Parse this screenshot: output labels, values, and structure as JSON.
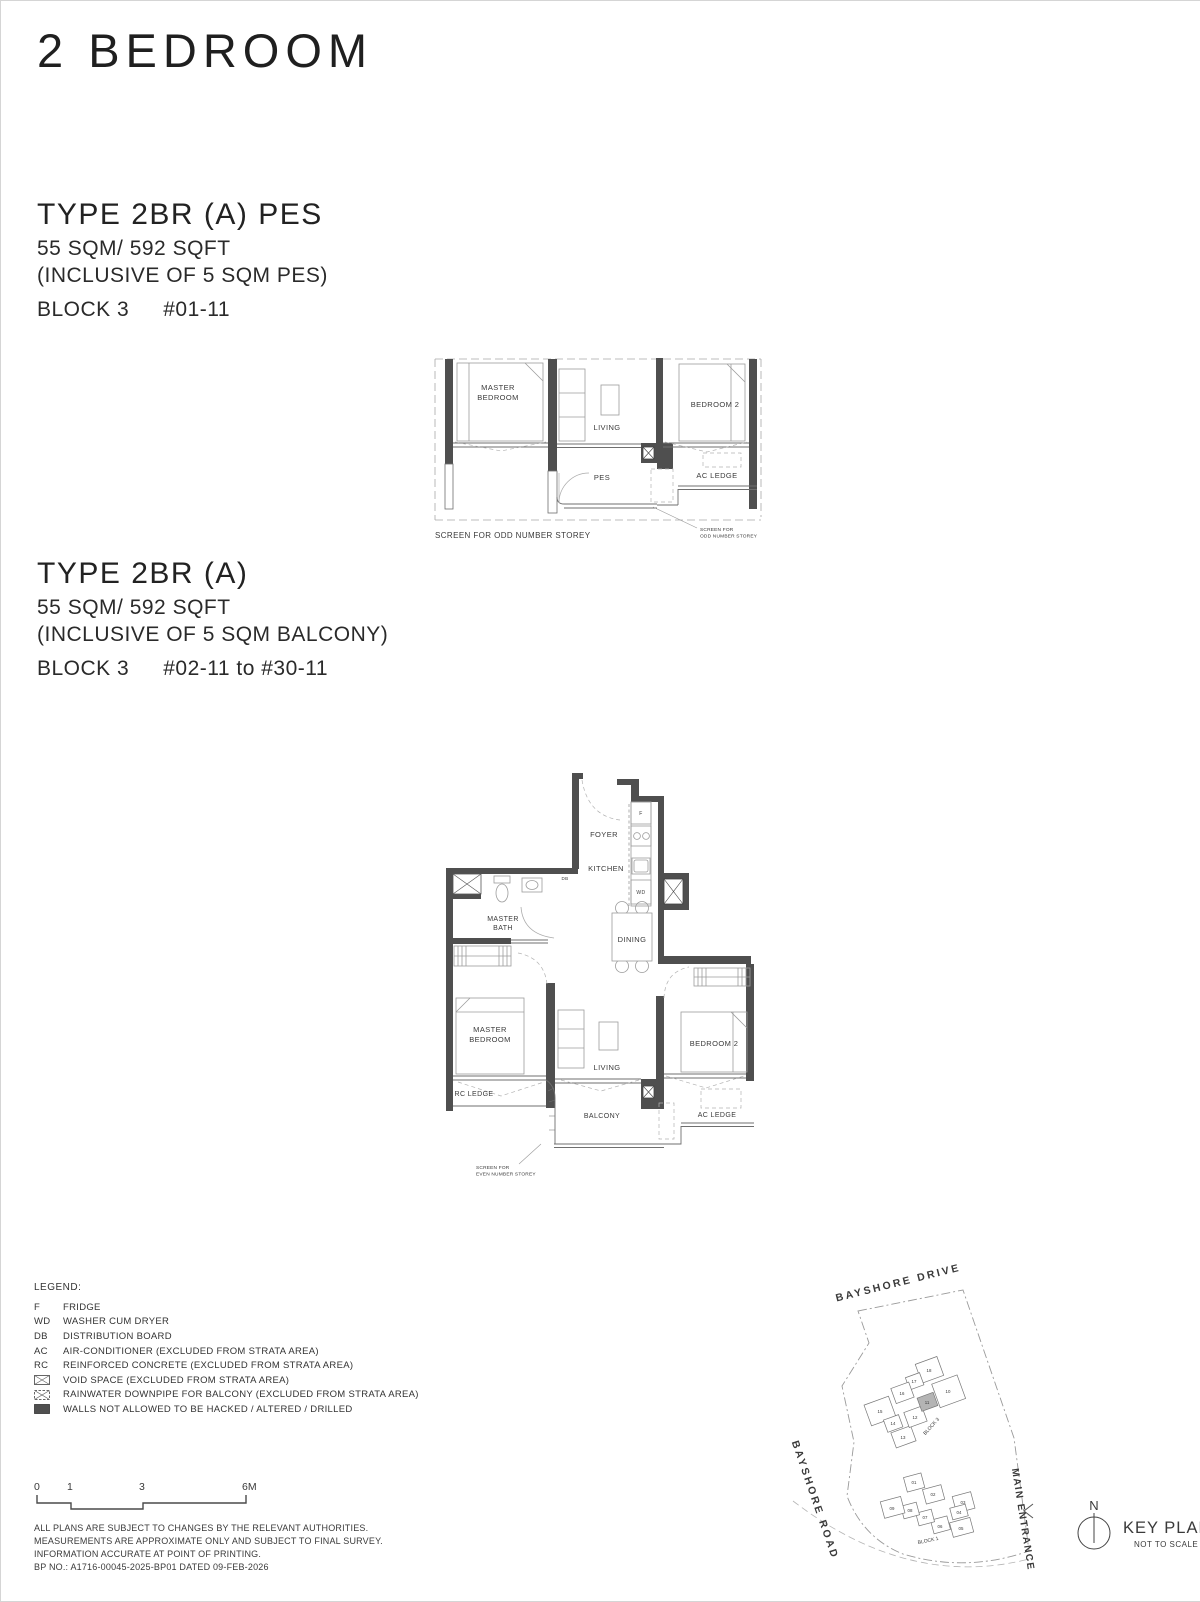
{
  "page": {
    "title": "2 BEDROOM"
  },
  "sections": [
    {
      "type_title": "TYPE 2BR (A) PES",
      "area": "55 SQM/ 592 SQFT",
      "inclusive": "(INCLUSIVE OF 5 SQM PES)",
      "block": "BLOCK 3",
      "units": "#01-11"
    },
    {
      "type_title": "TYPE 2BR (A)",
      "area": "55 SQM/ 592 SQFT",
      "inclusive": "(INCLUSIVE OF 5 SQM BALCONY)",
      "block": "BLOCK 3",
      "units": "#02-11 to #30-11"
    }
  ],
  "plan1": {
    "labels": {
      "master_l1": "MASTER",
      "master_l2": "BEDROOM",
      "living": "LIVING",
      "bedroom2": "BEDROOM 2",
      "pes": "PES",
      "ac_ledge": "AC LEDGE",
      "screen_note": "SCREEN FOR ODD NUMBER STOREY",
      "screen_small_l1": "SCREEN FOR",
      "screen_small_l2": "ODD NUMBER STOREY"
    }
  },
  "plan2": {
    "labels": {
      "foyer": "FOYER",
      "kitchen": "KITCHEN",
      "f": "F",
      "wd": "WD",
      "db": "DB",
      "master_bath_l1": "MASTER",
      "master_bath_l2": "BATH",
      "dining": "DINING",
      "master_l1": "MASTER",
      "master_l2": "BEDROOM",
      "living": "LIVING",
      "bedroom2": "BEDROOM 2",
      "rc_ledge": "RC LEDGE",
      "balcony": "BALCONY",
      "ac_ledge": "AC LEDGE",
      "screen_l1": "SCREEN FOR",
      "screen_l2": "EVEN NUMBER STOREY"
    }
  },
  "legend": {
    "heading": "LEGEND:",
    "items": [
      {
        "key": "F",
        "desc": "FRIDGE"
      },
      {
        "key": "WD",
        "desc": "WASHER CUM DRYER"
      },
      {
        "key": "DB",
        "desc": "DISTRIBUTION BOARD"
      },
      {
        "key": "AC",
        "desc": "AIR-CONDITIONER (EXCLUDED FROM STRATA AREA)"
      },
      {
        "key": "RC",
        "desc": "REINFORCED CONCRETE (EXCLUDED FROM STRATA AREA)"
      },
      {
        "key": "",
        "desc": "VOID SPACE (EXCLUDED FROM STRATA AREA)"
      },
      {
        "key": "",
        "desc": "RAINWATER DOWNPIPE FOR BALCONY (EXCLUDED FROM STRATA AREA)"
      },
      {
        "key": "",
        "desc": "WALLS NOT ALLOWED TO BE HACKED / ALTERED / DRILLED"
      }
    ]
  },
  "scalebar": {
    "t0": "0",
    "t1": "1",
    "t3": "3",
    "t6": "6M"
  },
  "disclaimer": [
    "ALL PLANS ARE SUBJECT TO CHANGES BY THE RELEVANT AUTHORITIES.",
    "MEASUREMENTS ARE APPROXIMATE ONLY AND SUBJECT TO FINAL SURVEY.",
    "INFORMATION ACCURATE AT POINT OF PRINTING.",
    "BP NO.: A1716-00045-2025-BP01 DATED 09-FEB-2026"
  ],
  "keyplan": {
    "roads": {
      "top": "BAYSHORE DRIVE",
      "left": "BAYSHORE ROAD",
      "right": "MAIN ENTRANCE"
    },
    "block3_label": "BLOCK 3",
    "block1_label": "BLOCK 1",
    "block3_units": [
      "18",
      "17",
      "16",
      "15",
      "14",
      "13",
      "12",
      "11",
      "10"
    ],
    "block1_units": [
      "01",
      "02",
      "03",
      "04",
      "05",
      "06",
      "07",
      "08",
      "09"
    ],
    "highlighted_unit": "11",
    "north": "N",
    "title": "KEY PLAN",
    "subtitle": "NOT TO SCALE"
  },
  "colors": {
    "ink": "#262626",
    "wall_fill": "#4f4f4f",
    "highlight_unit_fill": "#b4b4b4"
  }
}
